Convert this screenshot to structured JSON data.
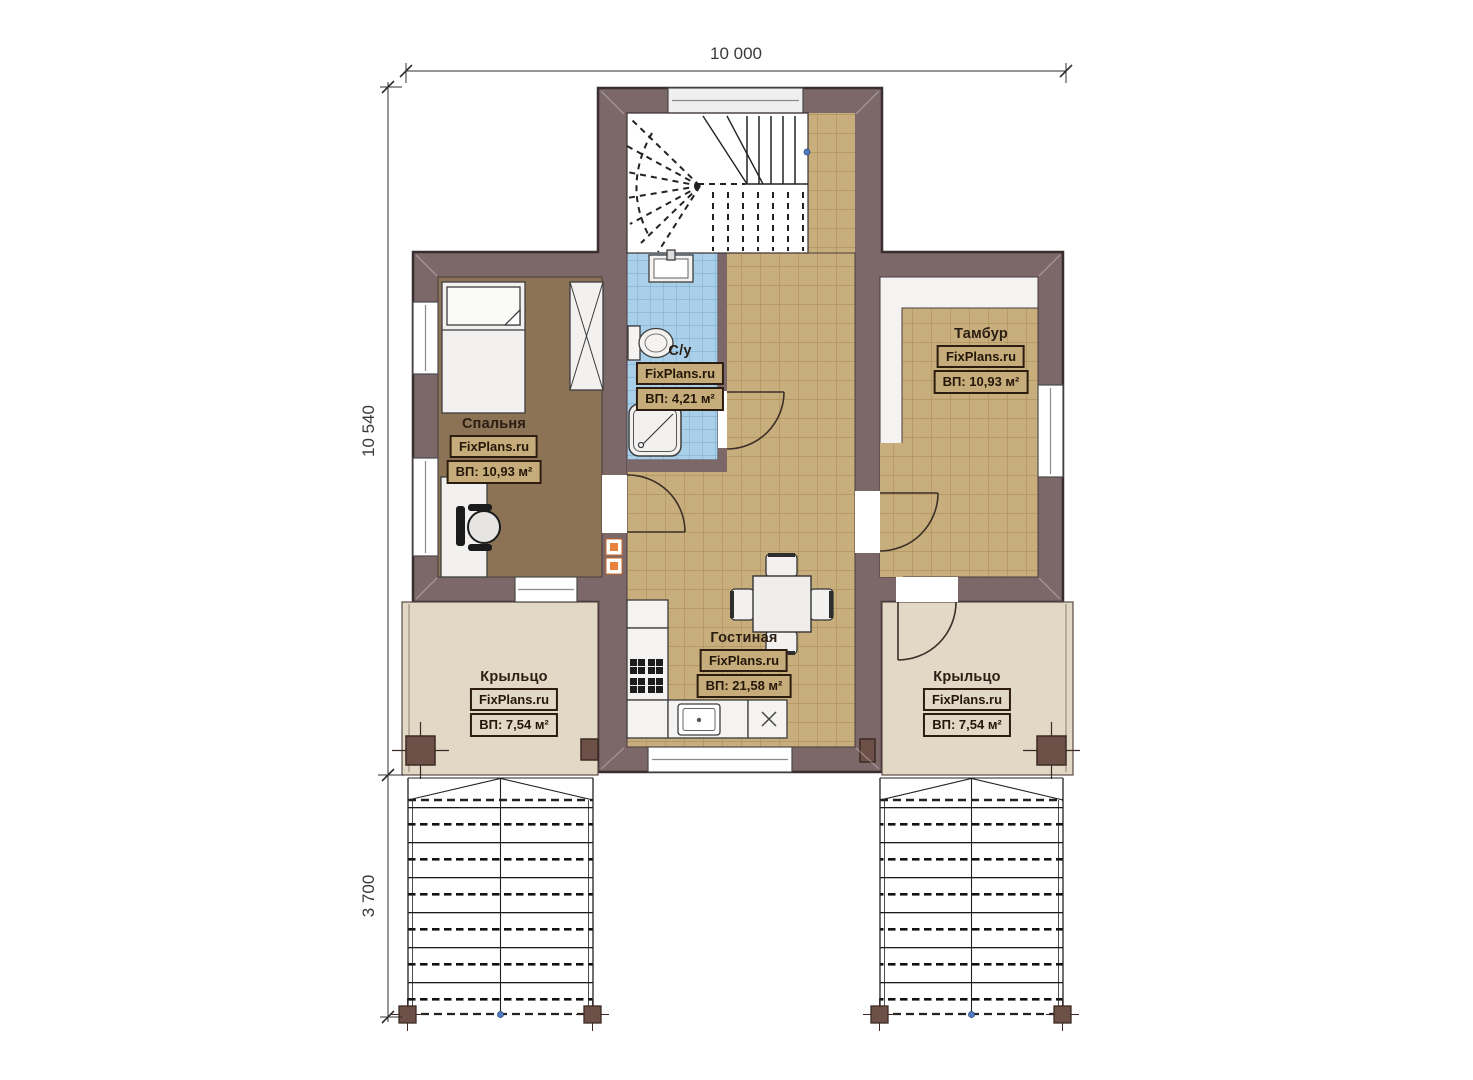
{
  "plan": {
    "brand": "FixPlans.ru",
    "dimensions": {
      "width_top": "10 000",
      "height_left": "10 540",
      "stairs_depth": "3 700"
    },
    "rooms": {
      "bedroom": {
        "name": "Спальня",
        "brand": "FixPlans.ru",
        "area": "ВП: 10,93 м²"
      },
      "bathroom": {
        "name": "С/у",
        "brand": "FixPlans.ru",
        "area": "ВП: 4,21 м²"
      },
      "vestibule": {
        "name": "Тамбур",
        "brand": "FixPlans.ru",
        "area": "ВП: 10,93 м²"
      },
      "living": {
        "name": "Гостиная",
        "brand": "FixPlans.ru",
        "area": "ВП: 21,58 м²"
      },
      "porch_left": {
        "name": "Крыльцо",
        "brand": "FixPlans.ru",
        "area": "ВП: 7,54 м²"
      },
      "porch_right": {
        "name": "Крыльцо",
        "brand": "FixPlans.ru",
        "area": "ВП: 7,54 м²"
      }
    },
    "colors": {
      "wall": "#7c6769",
      "tile": "#c8ae7d",
      "bathroom_tile": "#aacfe9",
      "bedroom_floor": "#8d7355",
      "porch": "#e2d8c6",
      "accent": "#e07a33"
    }
  }
}
